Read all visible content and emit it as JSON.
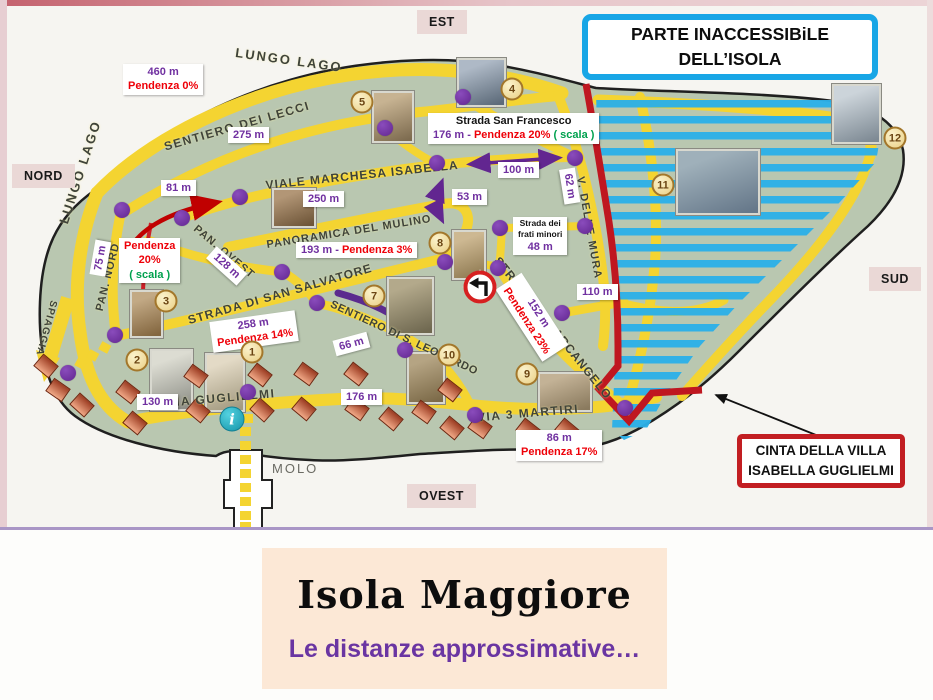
{
  "footer": {
    "title": "Isola Maggiore",
    "subtitle": "Le distanze approssimative…"
  },
  "callouts": {
    "inaccessible": {
      "line1": "PARTE INACCESSIBiLE",
      "line2": "DELL’ISOLA"
    },
    "cinta": {
      "line1": "CINTA DELLA VILLA",
      "line2": "ISABELLA GUGLIELMI"
    }
  },
  "poi": {
    "molo": "MOLO",
    "info_label": "i"
  },
  "colors": {
    "road_yellow": "#f4d431",
    "island_green": "#b9c7b0",
    "hatch_blue": "#2bb0e8",
    "boundary_red": "#bf1720",
    "purple": "#7030a0",
    "distance_red": "#ee0008",
    "scala_green": "#00a14e",
    "footer_peach": "#fce8d6",
    "subtitle_purple": "#6a35a2"
  },
  "compass": [
    {
      "label": "EST",
      "x": 417,
      "y": 10
    },
    {
      "label": "NORD",
      "x": 12,
      "y": 164
    },
    {
      "label": "SUD",
      "x": 869,
      "y": 267
    },
    {
      "label": "OVEST",
      "x": 407,
      "y": 484
    }
  ],
  "map": {
    "streets": [
      {
        "name": "LUNGO LAGO",
        "x": 289,
        "y": 60,
        "rot": 8,
        "size": 13,
        "ls": 2
      },
      {
        "name": "LUNGO LAGO",
        "x": 80,
        "y": 172,
        "rot": -72,
        "size": 13,
        "ls": 2
      },
      {
        "name": "SENTIERO DEI LECCI",
        "x": 237,
        "y": 126,
        "rot": -16,
        "size": 12,
        "ls": 1.5
      },
      {
        "name": "VIALE MARCHESA  ISABELLA",
        "x": 362,
        "y": 175,
        "rot": -6,
        "size": 12,
        "ls": 1
      },
      {
        "name": "PANORAMICA DEL MULINO",
        "x": 349,
        "y": 232,
        "rot": -9,
        "size": 11,
        "ls": 1
      },
      {
        "name": "PAN. OVEST",
        "x": 224,
        "y": 252,
        "rot": 40,
        "size": 11,
        "ls": 1
      },
      {
        "name": "PAN. NORD",
        "x": 108,
        "y": 277,
        "rot": -76,
        "size": 11,
        "ls": 1
      },
      {
        "name": "STRADA DI SAN SALVATORE",
        "x": 280,
        "y": 294,
        "rot": -16,
        "size": 12,
        "ls": 1
      },
      {
        "name": "SENTIERO DI S. LEONARDO",
        "x": 404,
        "y": 338,
        "rot": 25,
        "size": 11,
        "ls": 0.5
      },
      {
        "name": "STRADA S.M. ARCANGELO",
        "x": 553,
        "y": 328,
        "rot": 51,
        "size": 12,
        "ls": 1
      },
      {
        "name": "V. DELLE MURA",
        "x": 589,
        "y": 228,
        "rot": 80,
        "size": 11,
        "ls": 1.5
      },
      {
        "name": "VIA GUGLIELMI",
        "x": 221,
        "y": 398,
        "rot": -5,
        "size": 12,
        "ls": 1.5
      },
      {
        "name": "VIA 3 MARTIRI",
        "x": 528,
        "y": 413,
        "rot": -5,
        "size": 12,
        "ls": 1.5
      },
      {
        "name": "SPIAGGIA",
        "x": 46,
        "y": 328,
        "rot": 105,
        "size": 10,
        "ls": 1
      }
    ],
    "distances": [
      {
        "x": 123,
        "y": 64,
        "lines": [
          [
            {
              "t": "460 m",
              "c": "p"
            }
          ],
          [
            {
              "t": "Pendenza 0%",
              "c": "r"
            }
          ]
        ]
      },
      {
        "x": 228,
        "y": 127,
        "lines": [
          [
            {
              "t": "275 m",
              "c": "p"
            }
          ]
        ]
      },
      {
        "x": 161,
        "y": 180,
        "lines": [
          [
            {
              "t": "81 m",
              "c": "p"
            }
          ]
        ]
      },
      {
        "x": 303,
        "y": 191,
        "lines": [
          [
            {
              "t": "250 m",
              "c": "p"
            }
          ]
        ]
      },
      {
        "x": 498,
        "y": 162,
        "lines": [
          [
            {
              "t": "100 m",
              "c": "p"
            }
          ]
        ]
      },
      {
        "x": 452,
        "y": 189,
        "lines": [
          [
            {
              "t": "53 m",
              "c": "p"
            }
          ]
        ]
      },
      {
        "x": 552,
        "y": 178,
        "rot": 81,
        "lines": [
          [
            {
              "t": "62 m",
              "c": "p"
            }
          ]
        ]
      },
      {
        "x": 428,
        "y": 113,
        "lines": [
          [
            {
              "t": "Strada San Francesco",
              "c": "k"
            }
          ],
          [
            {
              "t": "176 m  -  ",
              "c": "p"
            },
            {
              "t": "Pendenza 20% ",
              "c": "r"
            },
            {
              "t": "( scala )",
              "c": "g"
            }
          ]
        ]
      },
      {
        "x": 296,
        "y": 242,
        "lines": [
          [
            {
              "t": "193 m  -  ",
              "c": "p"
            },
            {
              "t": "Pendenza 3%",
              "c": "r"
            }
          ]
        ]
      },
      {
        "x": 206,
        "y": 258,
        "rot": 42,
        "lines": [
          [
            {
              "t": "128 m",
              "c": "p"
            }
          ]
        ]
      },
      {
        "x": 83,
        "y": 250,
        "rot": -80,
        "lines": [
          [
            {
              "t": "75 m",
              "c": "p"
            }
          ]
        ]
      },
      {
        "x": 119,
        "y": 238,
        "lines": [
          [
            {
              "t": "Pendenza",
              "c": "r"
            }
          ],
          [
            {
              "t": "20%",
              "c": "r"
            }
          ],
          [
            {
              "t": "( scala )",
              "c": "g"
            }
          ]
        ]
      },
      {
        "x": 211,
        "y": 316,
        "rot": -8,
        "lines": [
          [
            {
              "t": "258 m",
              "c": "p"
            }
          ],
          [
            {
              "t": "Pendenza 14%",
              "c": "r"
            }
          ]
        ]
      },
      {
        "x": 334,
        "y": 336,
        "rot": -15,
        "lines": [
          [
            {
              "t": "66 m",
              "c": "p"
            }
          ]
        ]
      },
      {
        "x": 137,
        "y": 394,
        "lines": [
          [
            {
              "t": "130 m",
              "c": "p"
            }
          ]
        ]
      },
      {
        "x": 341,
        "y": 389,
        "lines": [
          [
            {
              "t": "176 m",
              "c": "p"
            }
          ]
        ]
      },
      {
        "x": 489,
        "y": 302,
        "rot": 57,
        "lines": [
          [
            {
              "t": "152 m",
              "c": "p"
            }
          ],
          [
            {
              "t": "Pendenza 23%",
              "c": "r"
            }
          ]
        ]
      },
      {
        "x": 577,
        "y": 284,
        "lines": [
          [
            {
              "t": "110 m",
              "c": "p"
            }
          ]
        ]
      },
      {
        "x": 513,
        "y": 217,
        "small": true,
        "lines": [
          [
            {
              "t": "Strada dei",
              "c": "k"
            }
          ],
          [
            {
              "t": "frati minori",
              "c": "k"
            }
          ],
          [
            {
              "t": "48 m",
              "c": "p"
            }
          ]
        ]
      },
      {
        "x": 516,
        "y": 430,
        "lines": [
          [
            {
              "t": "86 m",
              "c": "p"
            }
          ],
          [
            {
              "t": "Pendenza 17%",
              "c": "r"
            }
          ]
        ]
      }
    ],
    "markers": [
      {
        "n": "1",
        "x": 252,
        "y": 352
      },
      {
        "n": "2",
        "x": 137,
        "y": 360
      },
      {
        "n": "3",
        "x": 166,
        "y": 301
      },
      {
        "n": "4",
        "x": 512,
        "y": 89
      },
      {
        "n": "5",
        "x": 362,
        "y": 102
      },
      {
        "n": "7",
        "x": 374,
        "y": 296
      },
      {
        "n": "8",
        "x": 440,
        "y": 243
      },
      {
        "n": "9",
        "x": 527,
        "y": 374
      },
      {
        "n": "10",
        "x": 449,
        "y": 355
      },
      {
        "n": "11",
        "x": 663,
        "y": 185
      },
      {
        "n": "12",
        "x": 895,
        "y": 138
      }
    ],
    "junction_dots": [
      [
        122,
        210
      ],
      [
        182,
        218
      ],
      [
        240,
        197
      ],
      [
        385,
        128
      ],
      [
        463,
        97
      ],
      [
        437,
        163
      ],
      [
        575,
        158
      ],
      [
        500,
        228
      ],
      [
        585,
        226
      ],
      [
        445,
        262
      ],
      [
        498,
        268
      ],
      [
        282,
        272
      ],
      [
        317,
        303
      ],
      [
        405,
        350
      ],
      [
        562,
        313
      ],
      [
        625,
        408
      ],
      [
        475,
        415
      ],
      [
        248,
        392
      ],
      [
        115,
        335
      ],
      [
        68,
        373
      ]
    ],
    "houses": [
      [
        46,
        366,
        40
      ],
      [
        58,
        390,
        35
      ],
      [
        82,
        405,
        42
      ],
      [
        128,
        392,
        38
      ],
      [
        135,
        423,
        40
      ],
      [
        196,
        376,
        36
      ],
      [
        198,
        411,
        40
      ],
      [
        260,
        375,
        38
      ],
      [
        262,
        410,
        42
      ],
      [
        306,
        374,
        36
      ],
      [
        304,
        409,
        40
      ],
      [
        356,
        374,
        38
      ],
      [
        357,
        409,
        36
      ],
      [
        391,
        419,
        40
      ],
      [
        424,
        412,
        36
      ],
      [
        450,
        390,
        38
      ],
      [
        452,
        428,
        40
      ],
      [
        480,
        427,
        36
      ],
      [
        528,
        430,
        38
      ],
      [
        567,
        430,
        40
      ]
    ],
    "photos": [
      {
        "k": "chapel-5",
        "x": 372,
        "y": 91,
        "w": 38,
        "h": 48,
        "g1": "#c7b392",
        "g2": "#7e6c50"
      },
      {
        "k": "statue-4",
        "x": 457,
        "y": 58,
        "w": 45,
        "h": 45,
        "g1": "#aeb9c6",
        "g2": "#5d6b7a"
      },
      {
        "k": "mill-photo",
        "x": 272,
        "y": 188,
        "w": 40,
        "h": 36,
        "g1": "#b29676",
        "g2": "#6e5538"
      },
      {
        "k": "tower-12",
        "x": 832,
        "y": 84,
        "w": 45,
        "h": 56,
        "g1": "#ccd4da",
        "g2": "#7e8a94"
      },
      {
        "k": "village-11",
        "x": 676,
        "y": 149,
        "w": 80,
        "h": 62,
        "g1": "#9fb0ba",
        "g2": "#66788a"
      },
      {
        "k": "tower-3",
        "x": 130,
        "y": 290,
        "w": 29,
        "h": 44,
        "g1": "#c2a985",
        "g2": "#83663f"
      },
      {
        "k": "house-2",
        "x": 150,
        "y": 349,
        "w": 39,
        "h": 58,
        "g1": "#dcdcd2",
        "g2": "#8f9088"
      },
      {
        "k": "church-1",
        "x": 205,
        "y": 353,
        "w": 36,
        "h": 55,
        "g1": "#e3dac6",
        "g2": "#a39a80"
      },
      {
        "k": "ruin-7",
        "x": 387,
        "y": 277,
        "w": 43,
        "h": 54,
        "g1": "#b3a98b",
        "g2": "#6f6850"
      },
      {
        "k": "church-8",
        "x": 452,
        "y": 230,
        "w": 30,
        "h": 46,
        "g1": "#cdb892",
        "g2": "#8f7a52"
      },
      {
        "k": "ruin-10",
        "x": 407,
        "y": 352,
        "w": 34,
        "h": 48,
        "g1": "#b5a483",
        "g2": "#7c6a48"
      },
      {
        "k": "villa-9",
        "x": 538,
        "y": 372,
        "w": 50,
        "h": 36,
        "g1": "#c3b296",
        "g2": "#8a7a5e"
      }
    ]
  }
}
